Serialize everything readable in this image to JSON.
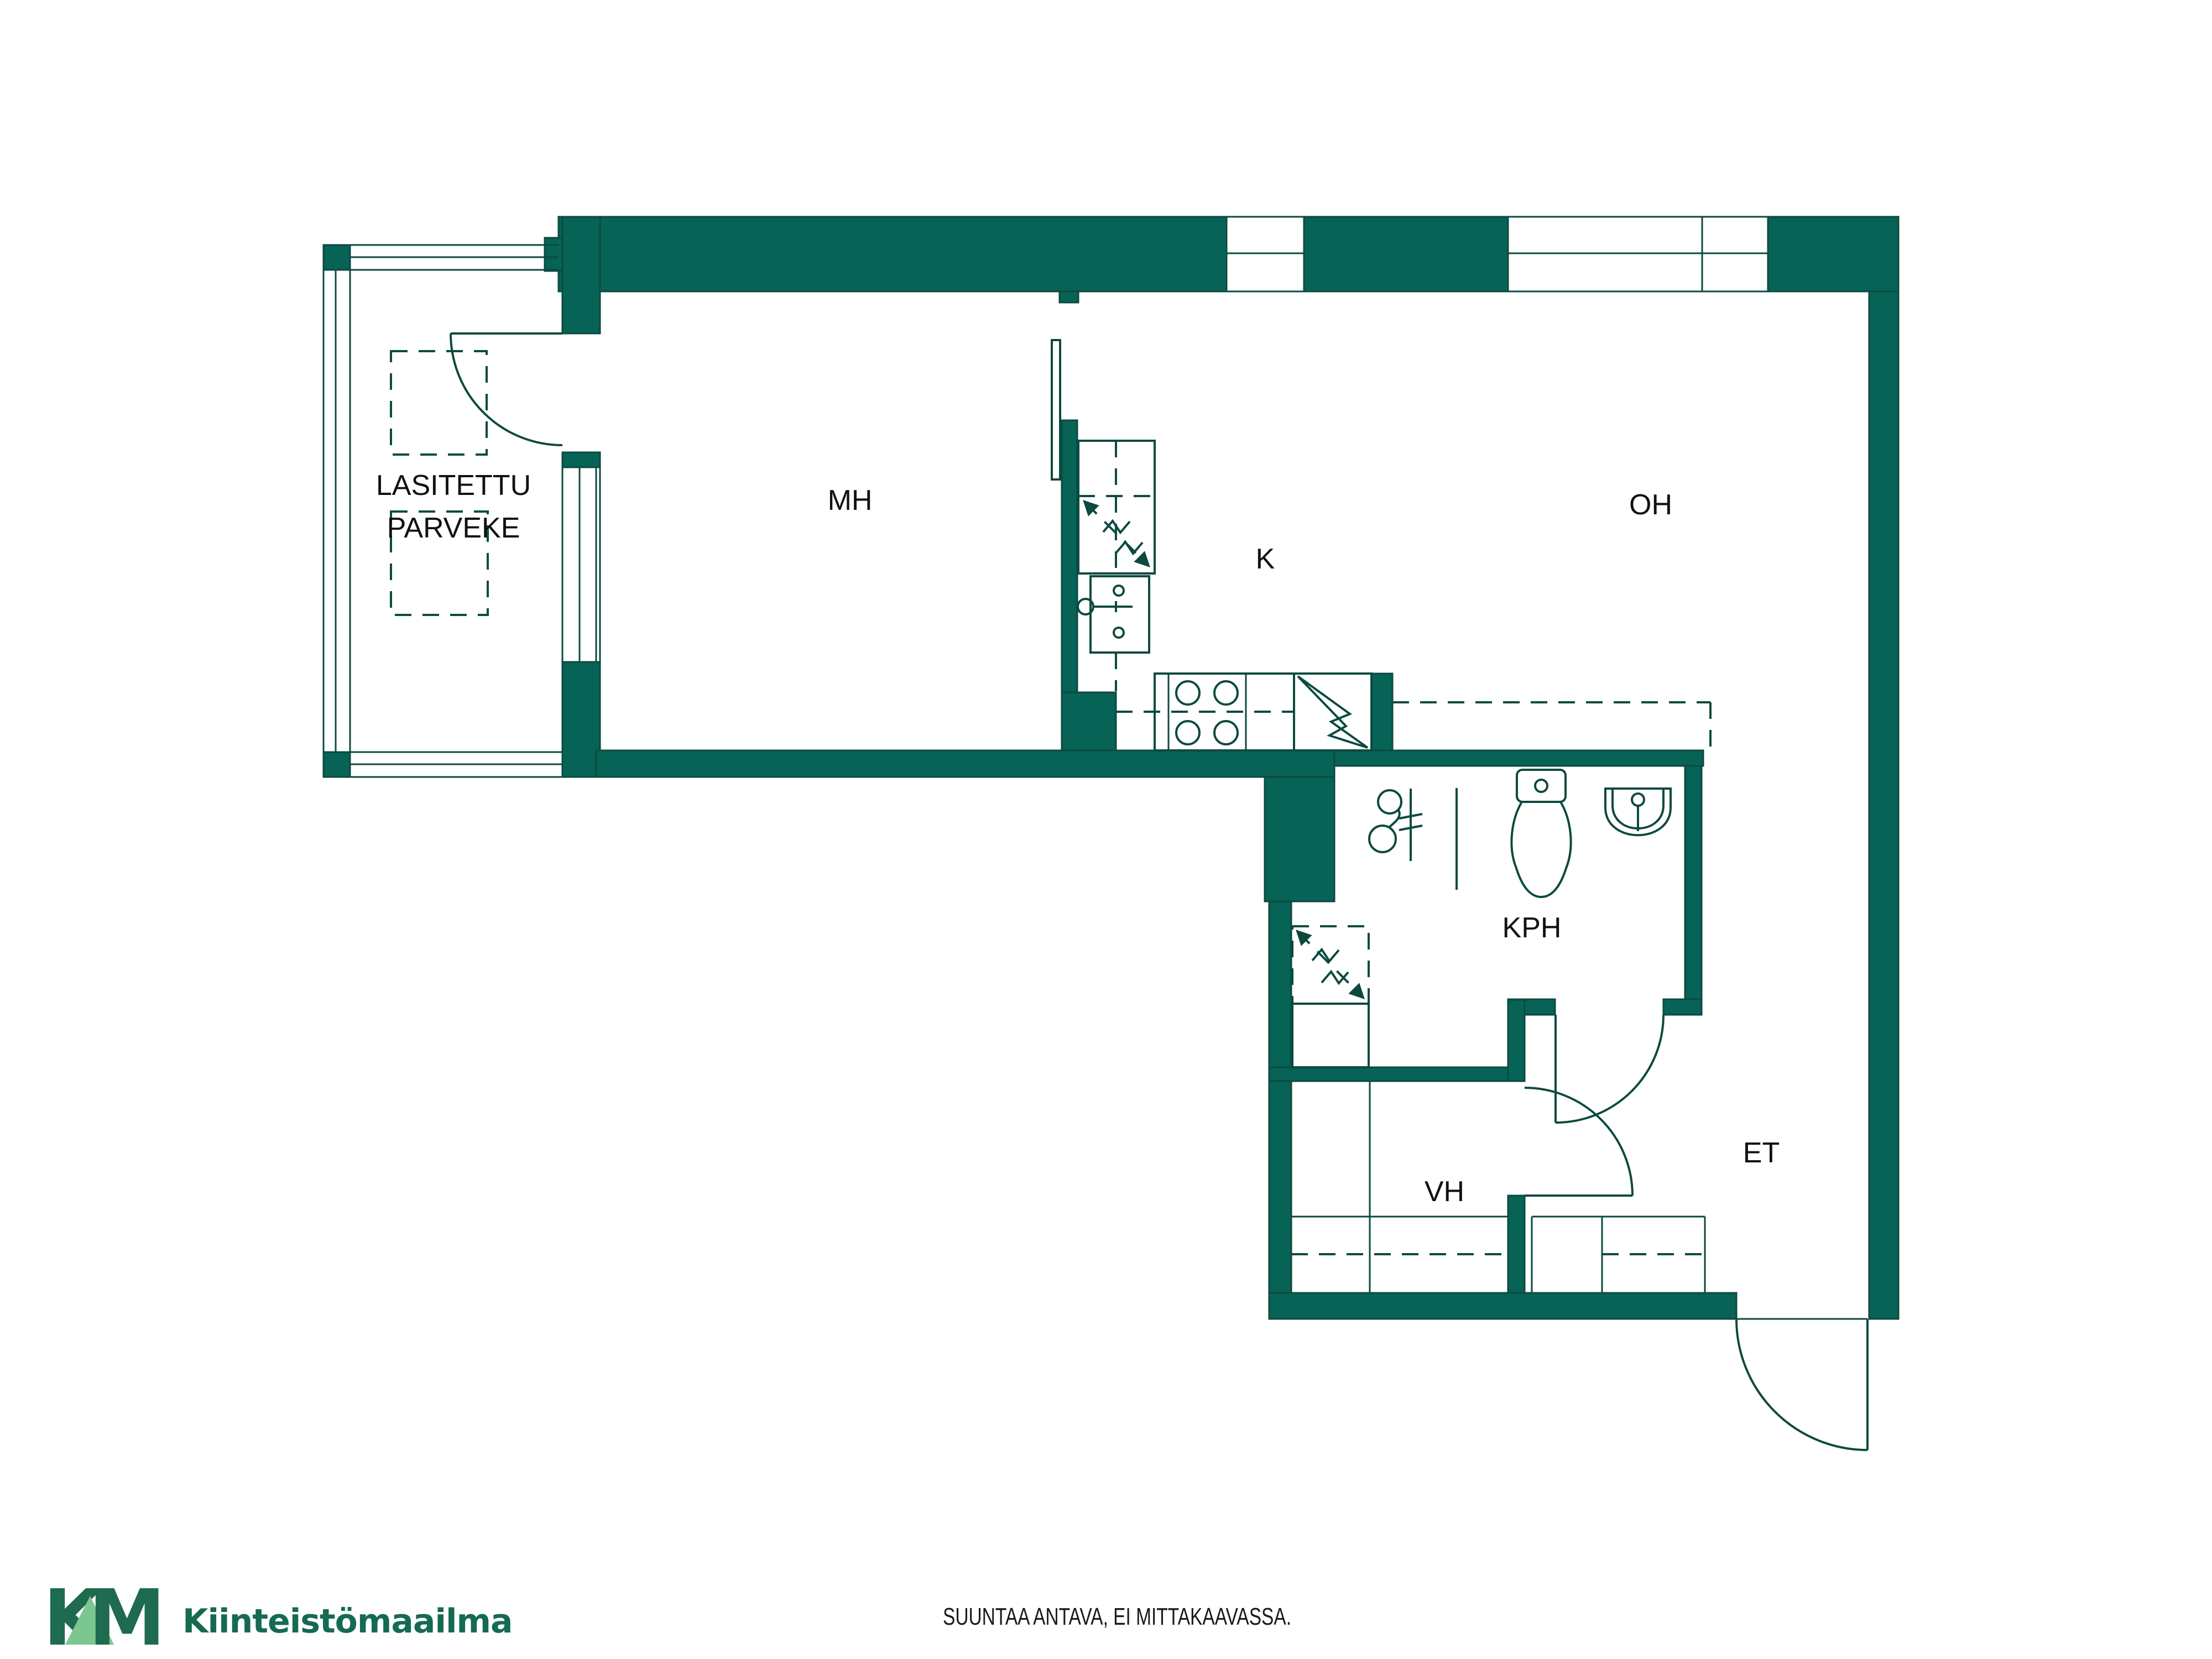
{
  "rooms": {
    "parveke": {
      "label_line1": "LASITETTU",
      "label_line2": "PARVEKE"
    },
    "mh": {
      "label": "MH"
    },
    "k": {
      "label": "K"
    },
    "oh": {
      "label": "OH"
    },
    "kph": {
      "label": "KPH"
    },
    "vh": {
      "label": "VH"
    },
    "et": {
      "label": "ET"
    }
  },
  "footer": {
    "disclaimer": "SUUNTAA ANTAVA, EI MITTAKAAVASSA."
  },
  "logo": {
    "monogram_k": "K",
    "monogram_m": "M",
    "wordmark": "Kiinteistömaailma"
  },
  "colors": {
    "wall": "#066356",
    "line": "#0c4a40",
    "label": "#111111",
    "logo_dark": "#1e6b50",
    "logo_light": "#7cc68f",
    "logo_text": "#156a52",
    "footer_text": "#1a1a1a"
  },
  "icons": {
    "balcony_door": "door-swing-icon",
    "bedroom_door": "open-door-leaf-icon",
    "bathroom_door": "door-swing-icon",
    "closet_door": "door-swing-icon",
    "entry_door": "door-swing-icon",
    "fridge_reservation": "dashed-arrow-appliance-icon",
    "washer_reservation": "dashed-arrow-appliance-icon",
    "electrical_box": "lightning-bolt-icon",
    "stove": "four-burner-stove-icon",
    "kitchen_sink": "sink-faucet-icon",
    "shower": "shower-drain-icon",
    "toilet": "toilet-icon",
    "washbasin": "washbasin-icon"
  }
}
